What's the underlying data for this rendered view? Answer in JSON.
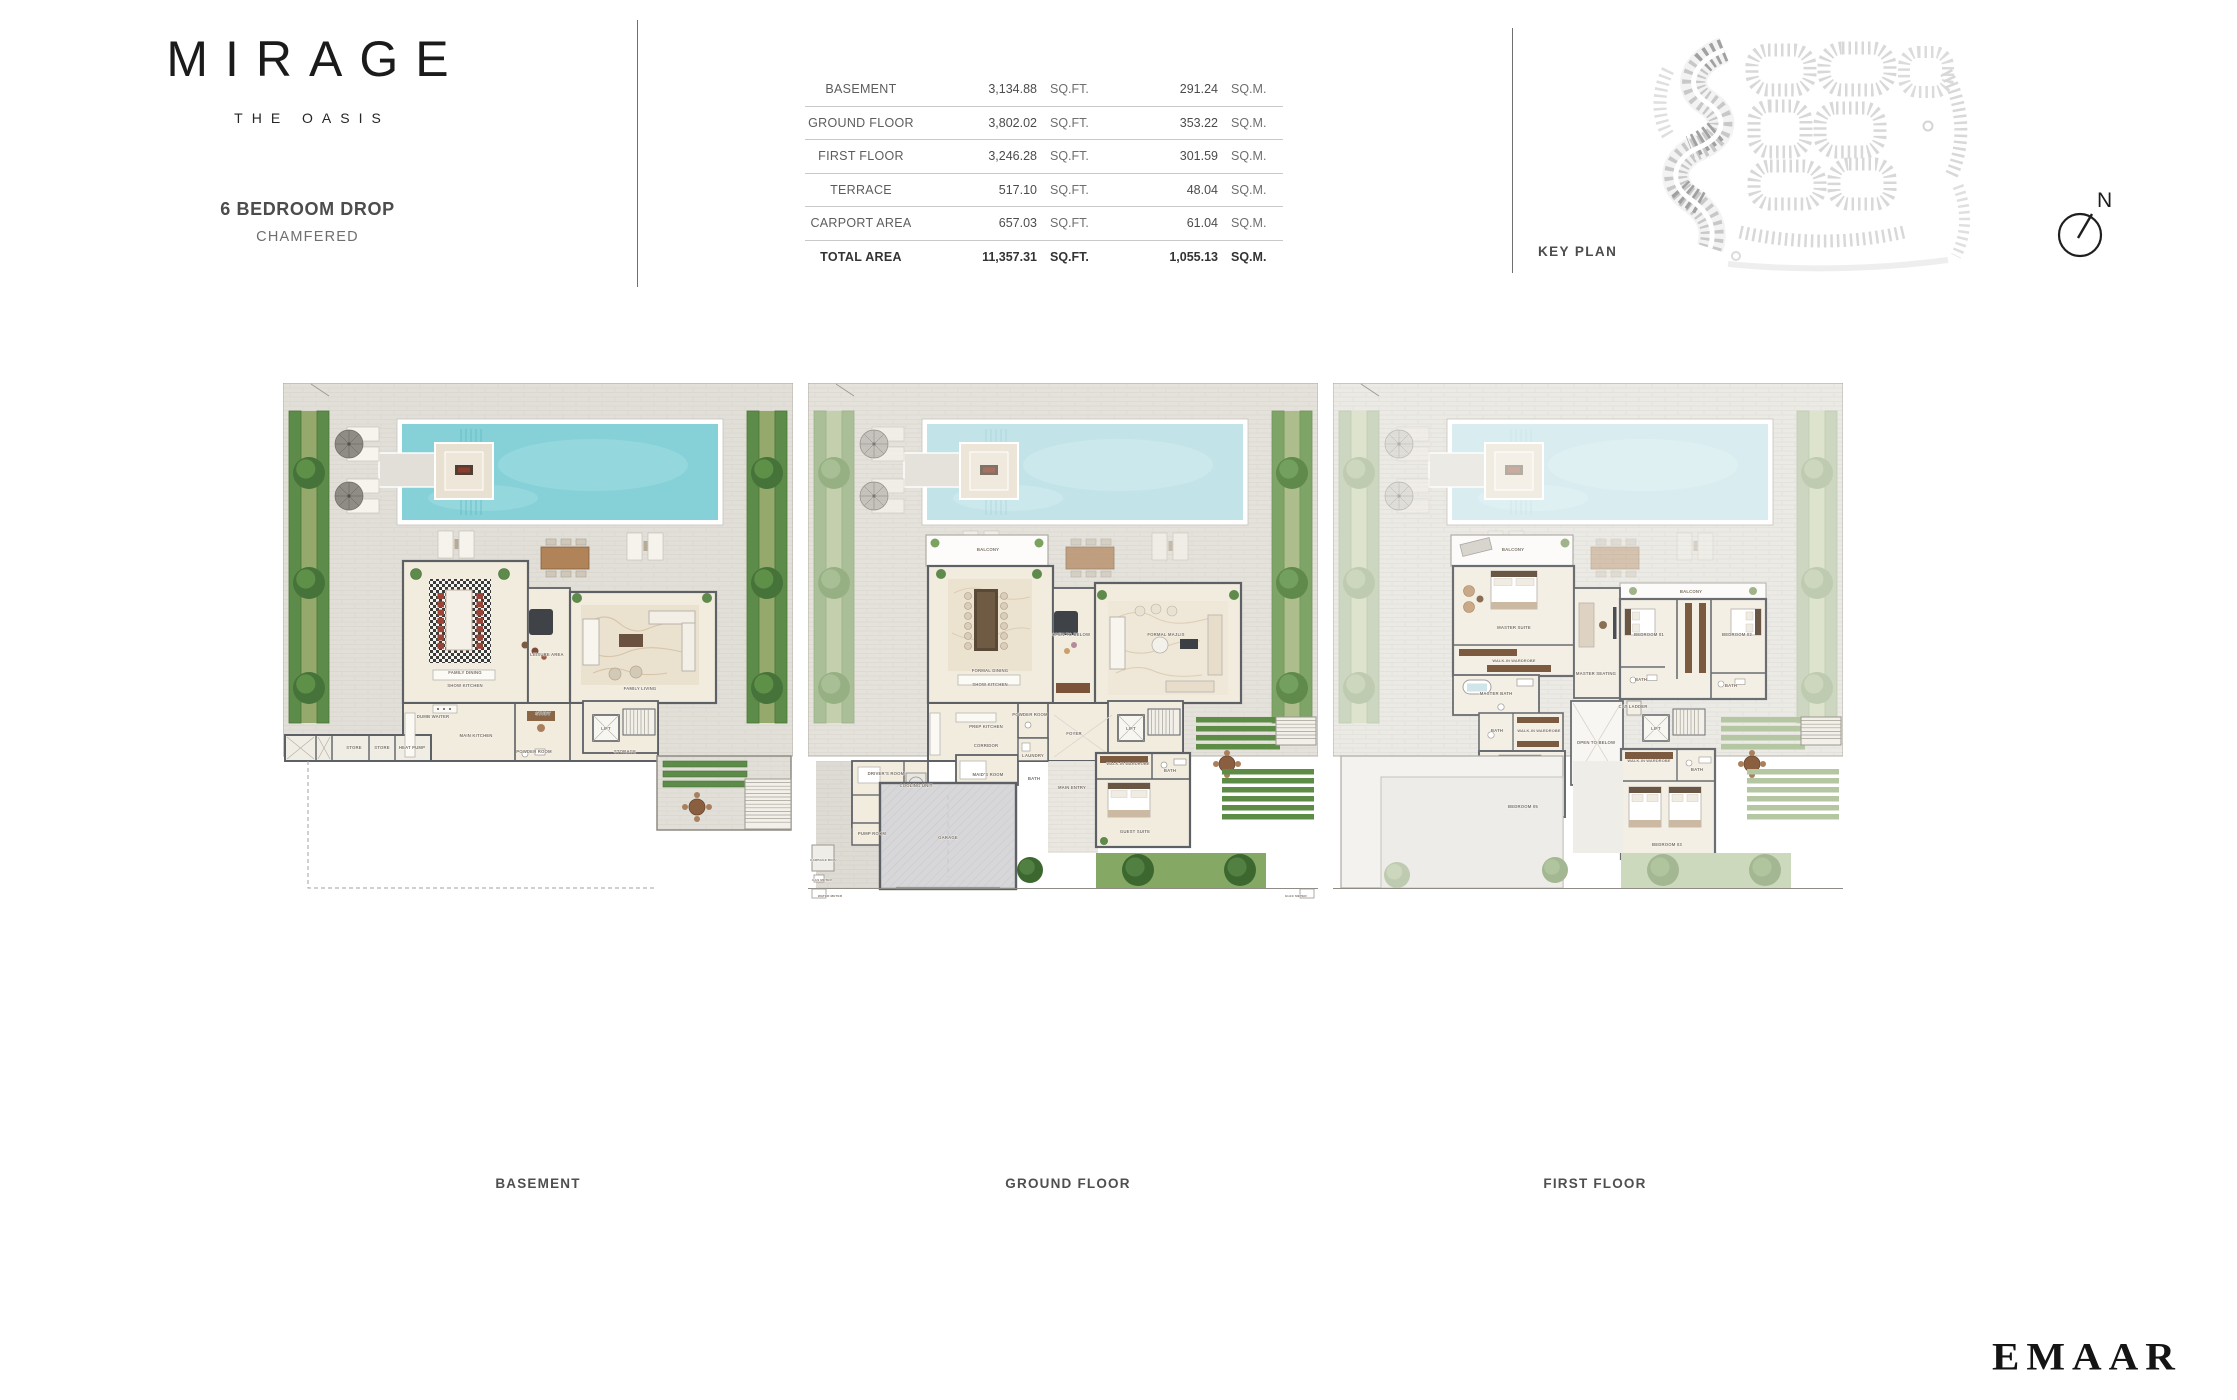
{
  "brand": {
    "name": "MIRAGE",
    "tagline": "THE OASIS"
  },
  "unit": {
    "title": "6 BEDROOM DROP",
    "subtitle": "CHAMFERED"
  },
  "area_table": {
    "rows": [
      {
        "label": "BASEMENT",
        "sqft": "3,134.88",
        "sqft_unit": "SQ.FT.",
        "sqm": "291.24",
        "sqm_unit": "SQ.M."
      },
      {
        "label": "GROUND FLOOR",
        "sqft": "3,802.02",
        "sqft_unit": "SQ.FT.",
        "sqm": "353.22",
        "sqm_unit": "SQ.M."
      },
      {
        "label": "FIRST FLOOR",
        "sqft": "3,246.28",
        "sqft_unit": "SQ.FT.",
        "sqm": "301.59",
        "sqm_unit": "SQ.M."
      },
      {
        "label": "TERRACE",
        "sqft": "517.10",
        "sqft_unit": "SQ.FT.",
        "sqm": "48.04",
        "sqm_unit": "SQ.M."
      },
      {
        "label": "CARPORT AREA",
        "sqft": "657.03",
        "sqft_unit": "SQ.FT.",
        "sqm": "61.04",
        "sqm_unit": "SQ.M."
      },
      {
        "label": "TOTAL AREA",
        "sqft": "11,357.31",
        "sqft_unit": "SQ.FT.",
        "sqm": "1,055.13",
        "sqm_unit": "SQ.M."
      }
    ]
  },
  "key_plan": {
    "label": "KEY PLAN",
    "compass_n": "N"
  },
  "developer": {
    "logo": "EMAAR"
  },
  "plans": [
    {
      "id": "basement",
      "caption": "BASEMENT",
      "rooms": [
        {
          "n": "FAMILY DINING",
          "x": 182,
          "y": 291
        },
        {
          "n": "SHOW KITCHEN",
          "x": 182,
          "y": 304
        },
        {
          "n": "LEISURE AREA",
          "x": 264,
          "y": 273
        },
        {
          "n": "FAMILY LIVING",
          "x": 357,
          "y": 307
        },
        {
          "n": "MAIN KITCHEN",
          "x": 193,
          "y": 354
        },
        {
          "n": "DUMB WAITER",
          "x": 150,
          "y": 335
        },
        {
          "n": "STUDY",
          "x": 260,
          "y": 332
        },
        {
          "n": "POWDER ROOM",
          "x": 251,
          "y": 370
        },
        {
          "n": "LIFT",
          "x": 323,
          "y": 347
        },
        {
          "n": "STORAGE",
          "x": 342,
          "y": 370
        },
        {
          "n": "STORE",
          "x": 71,
          "y": 366
        },
        {
          "n": "STORE",
          "x": 99,
          "y": 366
        },
        {
          "n": "HEAT PUMP",
          "x": 129,
          "y": 366
        }
      ]
    },
    {
      "id": "ground",
      "caption": "GROUND FLOOR",
      "rooms": [
        {
          "n": "BALCONY",
          "x": 180,
          "y": 168
        },
        {
          "n": "FORMAL DINING",
          "x": 182,
          "y": 289
        },
        {
          "n": "SHOW KITCHEN",
          "x": 182,
          "y": 303
        },
        {
          "n": "OPEN TO BELOW",
          "x": 263,
          "y": 253
        },
        {
          "n": "FORMAL MAJLIS",
          "x": 358,
          "y": 253
        },
        {
          "n": "PREP KITCHEN",
          "x": 178,
          "y": 345
        },
        {
          "n": "CORRIDOR",
          "x": 178,
          "y": 364
        },
        {
          "n": "POWDER ROOM",
          "x": 222,
          "y": 333
        },
        {
          "n": "FOYER",
          "x": 266,
          "y": 352
        },
        {
          "n": "LIFT",
          "x": 323,
          "y": 347
        },
        {
          "n": "LAUNDRY",
          "x": 225,
          "y": 374
        },
        {
          "n": "MAID'S ROOM",
          "x": 180,
          "y": 393
        },
        {
          "n": "BATH",
          "x": 226,
          "y": 397
        },
        {
          "n": "DRIVER'S ROOM",
          "x": 78,
          "y": 392
        },
        {
          "n": "COOLING UNIT",
          "x": 108,
          "y": 404
        },
        {
          "n": "PUMP ROOM",
          "x": 64,
          "y": 452
        },
        {
          "n": "GARAGE",
          "x": 140,
          "y": 456
        },
        {
          "n": "GARBAGE BINS",
          "x": 15,
          "y": 478
        },
        {
          "n": "MAIN ENTRY",
          "x": 264,
          "y": 406
        },
        {
          "n": "WALK-IN WARDROBE",
          "x": 320,
          "y": 382
        },
        {
          "n": "BATH",
          "x": 362,
          "y": 389
        },
        {
          "n": "GUEST SUITE",
          "x": 327,
          "y": 450
        },
        {
          "n": "GAS METER",
          "x": 14,
          "y": 498
        },
        {
          "n": "WATER METER",
          "x": 22,
          "y": 514
        },
        {
          "n": "ELEC METER",
          "x": 488,
          "y": 514
        }
      ]
    },
    {
      "id": "first",
      "caption": "FIRST FLOOR",
      "rooms": [
        {
          "n": "BALCONY",
          "x": 180,
          "y": 168
        },
        {
          "n": "MASTER SUITE",
          "x": 181,
          "y": 246
        },
        {
          "n": "WALK-IN WARDROBE",
          "x": 181,
          "y": 279
        },
        {
          "n": "MASTER BATH",
          "x": 163,
          "y": 312
        },
        {
          "n": "MASTER SEATING",
          "x": 263,
          "y": 292
        },
        {
          "n": "BALCONY",
          "x": 358,
          "y": 210
        },
        {
          "n": "BEDROOM 01",
          "x": 316,
          "y": 253
        },
        {
          "n": "BATH",
          "x": 308,
          "y": 298
        },
        {
          "n": "BEDROOM 02",
          "x": 404,
          "y": 253
        },
        {
          "n": "BATH",
          "x": 398,
          "y": 304
        },
        {
          "n": "OPEN TO BELOW",
          "x": 263,
          "y": 361
        },
        {
          "n": "CAT LADDER",
          "x": 300,
          "y": 325
        },
        {
          "n": "LIFT",
          "x": 323,
          "y": 347
        },
        {
          "n": "BATH",
          "x": 164,
          "y": 349
        },
        {
          "n": "WALK-IN WARDROBE",
          "x": 206,
          "y": 349
        },
        {
          "n": "BEDROOM 05",
          "x": 190,
          "y": 425
        },
        {
          "n": "WALK-IN WARDROBE",
          "x": 316,
          "y": 379
        },
        {
          "n": "BATH",
          "x": 364,
          "y": 388
        },
        {
          "n": "BEDROOM 03",
          "x": 334,
          "y": 463
        }
      ]
    }
  ]
}
